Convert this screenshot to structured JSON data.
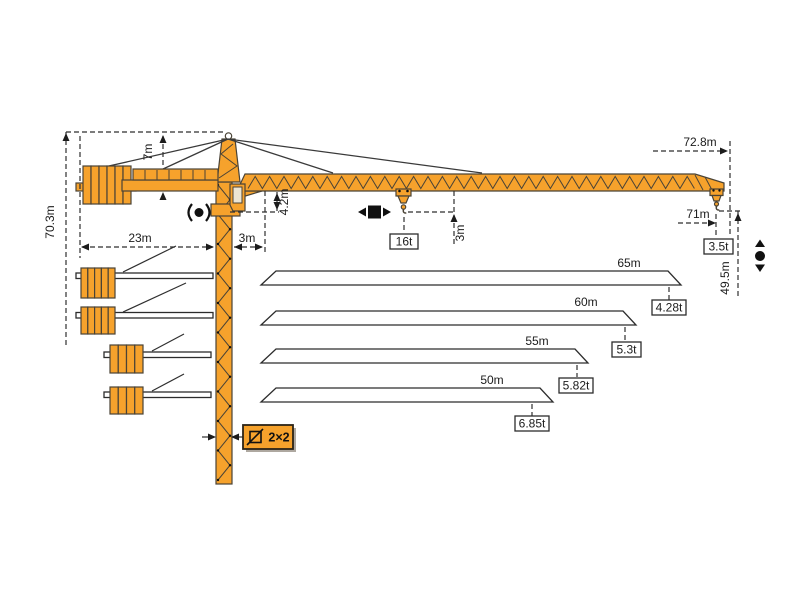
{
  "labels": {
    "total_height": "70.3m",
    "tower_top_height": "7m",
    "counterjib_radius": "23m",
    "slew_to_jib_foot": "3m",
    "jib_foot_height": "4.2m",
    "hook_to_jib": "3m",
    "max_capacity": "16t",
    "tip_radius": "72.8m",
    "tip_hook_radius": "71m",
    "tip_capacity": "3.5t",
    "tip_hook_height": "49.5m",
    "mast_section": "2×2"
  },
  "load_chart": {
    "type": "table",
    "rows": [
      {
        "jib_length": "65m",
        "tip_capacity": "4.28t"
      },
      {
        "jib_length": "60m",
        "tip_capacity": "5.3t"
      },
      {
        "jib_length": "55m",
        "tip_capacity": "5.82t"
      },
      {
        "jib_length": "50m",
        "tip_capacity": "6.85t"
      }
    ]
  },
  "icons": {
    "slewing_icon": "rotation",
    "trolley_travel_icon": "trolley-travel",
    "hoist_icon": "hook-up-down",
    "mast_section_icon": "mast-cross-section"
  },
  "colors": {
    "crane_orange": "#F6A22C",
    "outline": "#4a4336",
    "dimension": "#2f2f2f"
  }
}
